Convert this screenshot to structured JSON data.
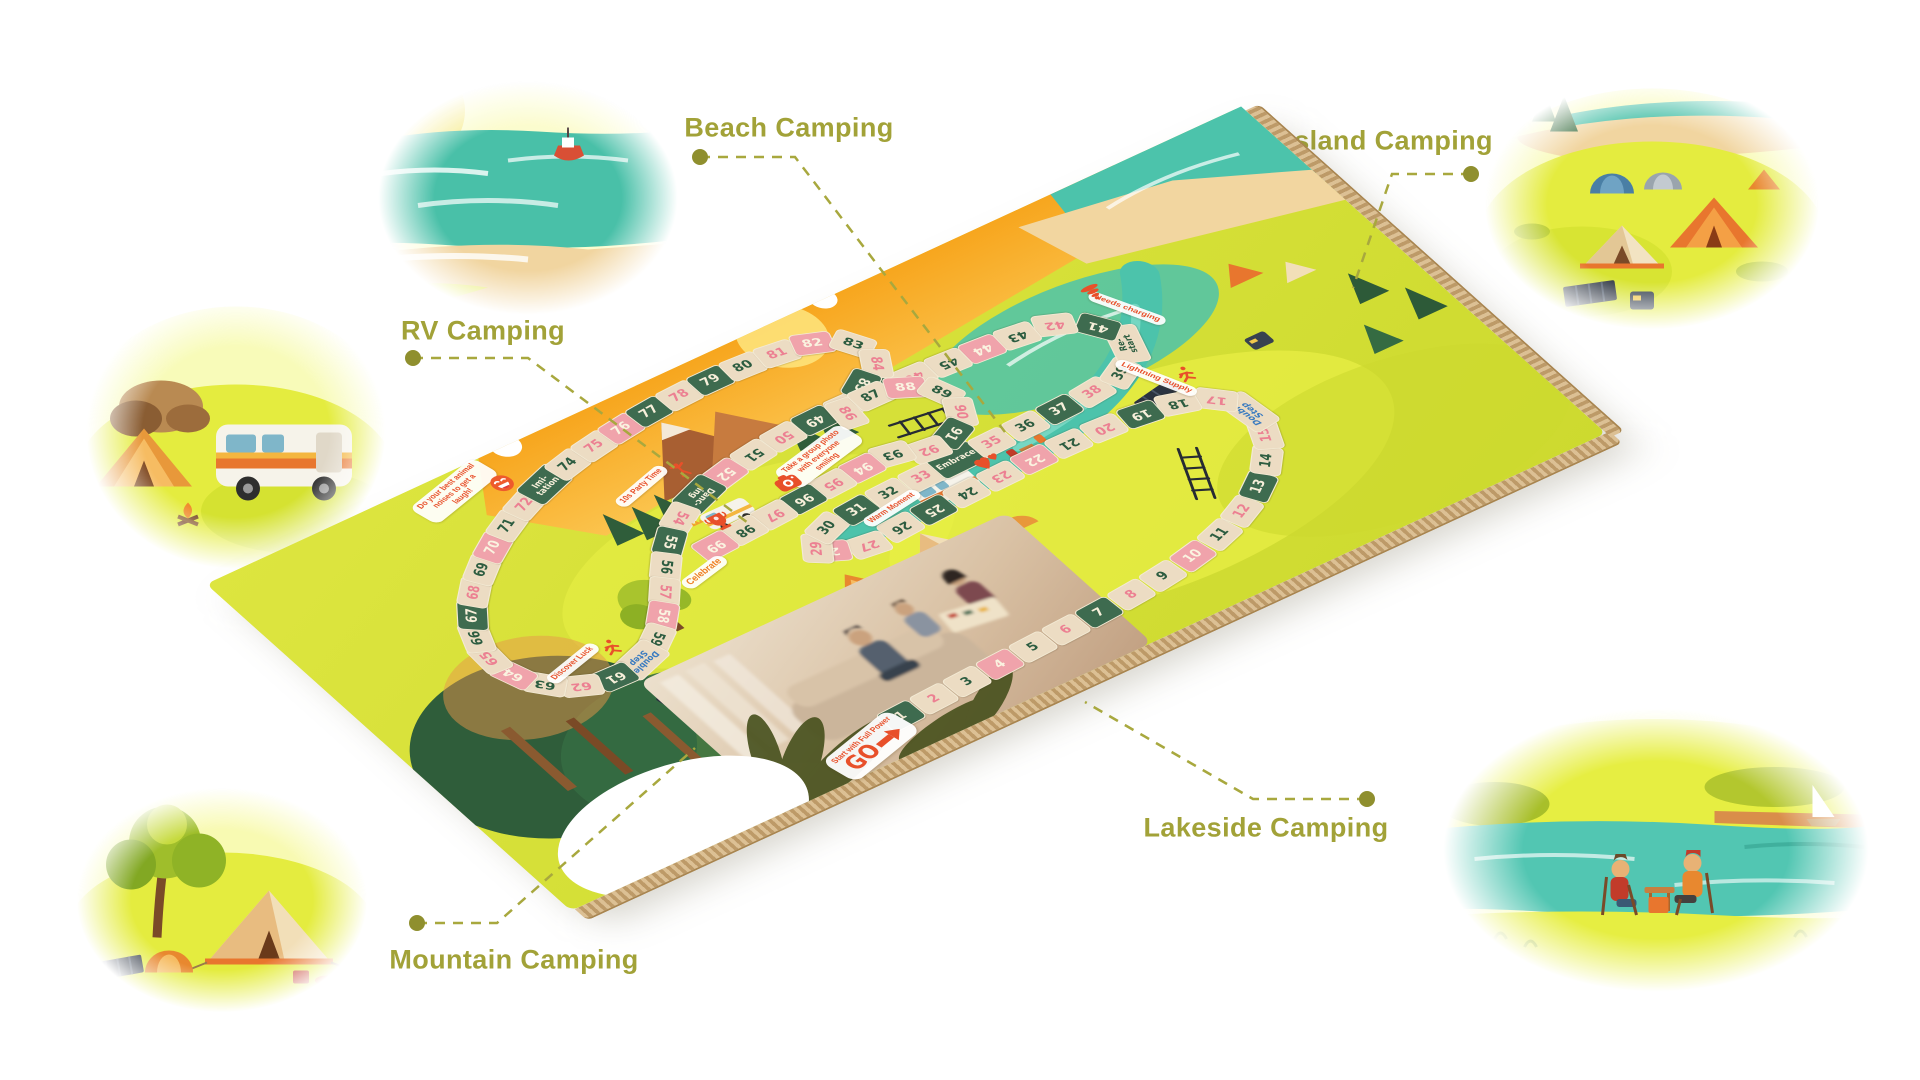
{
  "page": {
    "type": "board-game-product-visual",
    "background": "#ffffff"
  },
  "scenes": [
    {
      "id": "beach",
      "label": "Beach Camping"
    },
    {
      "id": "grassland",
      "label": "Grassland Camping"
    },
    {
      "id": "rv",
      "label": "RV Camping"
    },
    {
      "id": "mountain",
      "label": "Mountain Camping"
    },
    {
      "id": "lakeside",
      "label": "Lakeside Camping"
    }
  ],
  "board": {
    "go": {
      "label": "GO",
      "tagline": "Start with Full Power",
      "icon": "arrow-right"
    },
    "ladders": [
      [
        "11",
        "18"
      ],
      [
        "90",
        "93"
      ]
    ],
    "cells": [
      {
        "n": "1",
        "c": "g"
      },
      {
        "n": "2",
        "c": "bp"
      },
      {
        "n": "3",
        "c": "bg"
      },
      {
        "n": "4",
        "c": "p"
      },
      {
        "n": "5",
        "c": "bg"
      },
      {
        "n": "6",
        "c": "bp"
      },
      {
        "n": "7",
        "c": "g"
      },
      {
        "n": "8",
        "c": "bp"
      },
      {
        "n": "9",
        "c": "bg"
      },
      {
        "n": "10",
        "c": "p"
      },
      {
        "n": "11",
        "c": "bg"
      },
      {
        "n": "12",
        "c": "bp"
      },
      {
        "n": "13",
        "c": "g"
      },
      {
        "n": "14",
        "c": "bg"
      },
      {
        "n": "15",
        "c": "bp"
      },
      {
        "n": "16",
        "c": "sp",
        "label": "Double\nStep",
        "label_color": "blue",
        "tag": "Lightning Supply",
        "icon": "runner"
      },
      {
        "n": "17",
        "c": "bp"
      },
      {
        "n": "18",
        "c": "bg"
      },
      {
        "n": "19",
        "c": "g"
      },
      {
        "n": "20",
        "c": "bp"
      },
      {
        "n": "21",
        "c": "bg"
      },
      {
        "n": "22",
        "c": "p"
      },
      {
        "n": "23",
        "c": "bp"
      },
      {
        "n": "24",
        "c": "bg"
      },
      {
        "n": "25",
        "c": "g"
      },
      {
        "n": "26",
        "c": "bg"
      },
      {
        "n": "27",
        "c": "bp"
      },
      {
        "n": "28",
        "c": "p"
      },
      {
        "n": "29",
        "c": "bp"
      },
      {
        "n": "30",
        "c": "bg"
      },
      {
        "n": "31",
        "c": "g"
      },
      {
        "n": "32",
        "c": "bg"
      },
      {
        "n": "33",
        "c": "bp"
      },
      {
        "n": "34",
        "c": "spg",
        "label": "Embrace",
        "tag": "Warm Moment",
        "icon": "hearts"
      },
      {
        "n": "35",
        "c": "bp"
      },
      {
        "n": "36",
        "c": "bg"
      },
      {
        "n": "37",
        "c": "g"
      },
      {
        "n": "38",
        "c": "bp"
      },
      {
        "n": "39",
        "c": "bg"
      },
      {
        "n": "40",
        "c": "sp",
        "label": "Re-\nstart",
        "label_color": "green",
        "tag": "Needs charging",
        "icon": "tornado"
      },
      {
        "n": "41",
        "c": "g"
      },
      {
        "n": "42",
        "c": "bp"
      },
      {
        "n": "43",
        "c": "bg"
      },
      {
        "n": "44",
        "c": "p"
      },
      {
        "n": "45",
        "c": "bg"
      },
      {
        "n": "46",
        "c": "bp"
      },
      {
        "n": "47",
        "c": "g"
      },
      {
        "n": "48",
        "c": "bg"
      },
      {
        "n": "49",
        "c": "g"
      },
      {
        "n": "50",
        "c": "bp"
      },
      {
        "n": "51",
        "c": "bg"
      },
      {
        "n": "52",
        "c": "p"
      },
      {
        "n": "53",
        "c": "spg",
        "label": "Danc-\ning",
        "tag": "10s Party Time",
        "icon": "dancer"
      },
      {
        "n": "54",
        "c": "bp"
      },
      {
        "n": "55",
        "c": "g"
      },
      {
        "n": "56",
        "c": "bg"
      },
      {
        "n": "57",
        "c": "bp"
      },
      {
        "n": "58",
        "c": "p"
      },
      {
        "n": "59",
        "c": "bg"
      },
      {
        "n": "60",
        "c": "sp",
        "label": "Double\nStep",
        "label_color": "blue",
        "tag": "Discover Luck",
        "icon": "runner"
      },
      {
        "n": "61",
        "c": "g"
      },
      {
        "n": "62",
        "c": "bp"
      },
      {
        "n": "63",
        "c": "bg"
      },
      {
        "n": "64",
        "c": "p"
      },
      {
        "n": "65",
        "c": "bp"
      },
      {
        "n": "66",
        "c": "bg"
      },
      {
        "n": "67",
        "c": "g"
      },
      {
        "n": "68",
        "c": "bp"
      },
      {
        "n": "69",
        "c": "bg"
      },
      {
        "n": "70",
        "c": "p"
      },
      {
        "n": "71",
        "c": "bg"
      },
      {
        "n": "72",
        "c": "bp"
      },
      {
        "n": "73",
        "c": "spg",
        "label": "Imi-\ntation",
        "tag": "Do your best animal noises to get a laugh!",
        "icon": "laugh"
      },
      {
        "n": "74",
        "c": "bg"
      },
      {
        "n": "75",
        "c": "bp"
      },
      {
        "n": "76",
        "c": "p"
      },
      {
        "n": "77",
        "c": "g"
      },
      {
        "n": "78",
        "c": "bp"
      },
      {
        "n": "79",
        "c": "g"
      },
      {
        "n": "80",
        "c": "bg"
      },
      {
        "n": "81",
        "c": "bp"
      },
      {
        "n": "82",
        "c": "p"
      },
      {
        "n": "83",
        "c": "bg"
      },
      {
        "n": "84",
        "c": "bp"
      },
      {
        "n": "85",
        "c": "g"
      },
      {
        "n": "86",
        "c": "bp"
      },
      {
        "n": "87",
        "c": "bg"
      },
      {
        "n": "88",
        "c": "p"
      },
      {
        "n": "89",
        "c": "bg"
      },
      {
        "n": "90",
        "c": "bp"
      },
      {
        "n": "91",
        "c": "g"
      },
      {
        "n": "92",
        "c": "bp"
      },
      {
        "n": "93",
        "c": "bg"
      },
      {
        "n": "94",
        "c": "p"
      },
      {
        "n": "95",
        "c": "bp"
      },
      {
        "n": "96",
        "c": "g",
        "tag": "Take a group photo with everyone smiling",
        "icon": "camera"
      },
      {
        "n": "97",
        "c": "bp"
      },
      {
        "n": "98",
        "c": "bg"
      },
      {
        "n": "99",
        "c": "p",
        "tag": "Celebrate",
        "icon": "trophy"
      }
    ]
  },
  "colors": {
    "callout_olive": "#a2a238",
    "cell_green": "#3e6b4f",
    "cell_beige": "#ecdcc3",
    "cell_pink": "#f0a3ab",
    "number_green": "#2c5c40",
    "number_pink": "#ec8092",
    "accent_red": "#e8502a",
    "special_blue": "#3a7bc0",
    "board_orange": "#f6a01c",
    "board_grass": "#d9e13c",
    "sea_teal": "#4cc3ab",
    "cardboard": "#bd9a68"
  }
}
